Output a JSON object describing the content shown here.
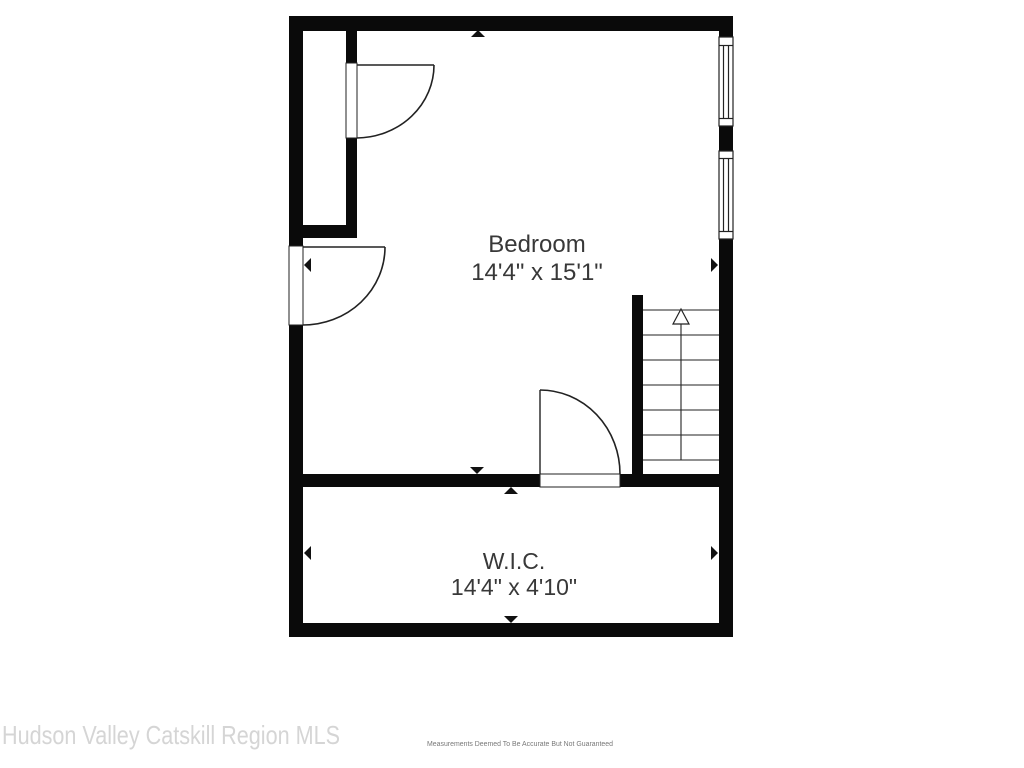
{
  "floor_plan": {
    "type": "residential-floor-plan",
    "rooms": [
      {
        "name": "Bedroom",
        "dimensions": "14'4\" x 15'1\""
      },
      {
        "name": "W.I.C.",
        "dimensions": "14'4\" x 4'10\""
      }
    ],
    "stairs": {
      "direction": "up",
      "tread_count": 6
    },
    "door_count": 3,
    "window_count": 2
  },
  "footer": {
    "watermark": "Hudson Valley Catskill Region MLS",
    "disclaimer": "Measurements Deemed To Be Accurate But Not Guaranteed"
  },
  "colors": {
    "wall": "#0a0a0a",
    "line": "#222222",
    "room_label": "#383838",
    "watermark": "#d5d5d5",
    "disclaimer": "#787878",
    "background": "#ffffff"
  }
}
